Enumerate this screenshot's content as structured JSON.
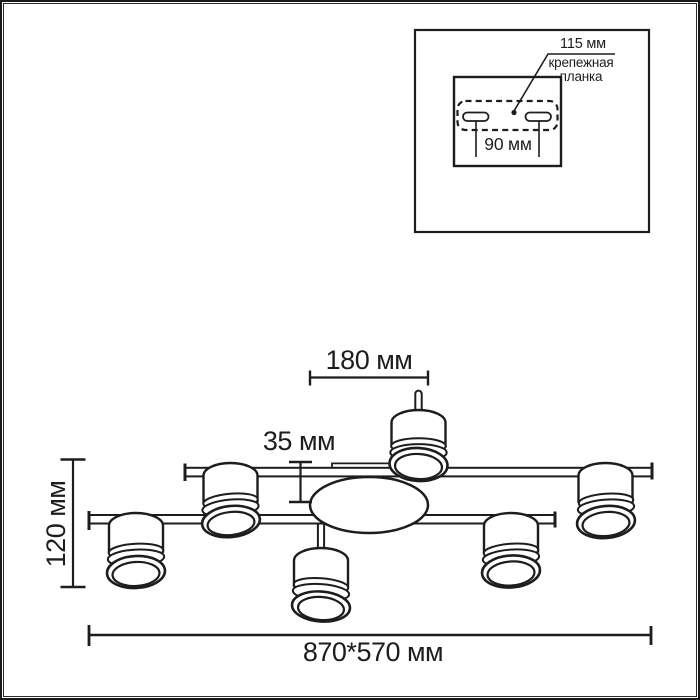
{
  "colors": {
    "ink": "#1d1d1b",
    "background": "#ffffff"
  },
  "inset": {
    "mount_width_label": "115 мм",
    "mount_plate_label": "крепежная планка",
    "hole_spacing_label": "90 мм"
  },
  "dimensions": {
    "top_span_label": "180 мм",
    "bar_offset_label": "35 мм",
    "height_label": "120 мм",
    "overall_size_label": "870*570 мм"
  }
}
